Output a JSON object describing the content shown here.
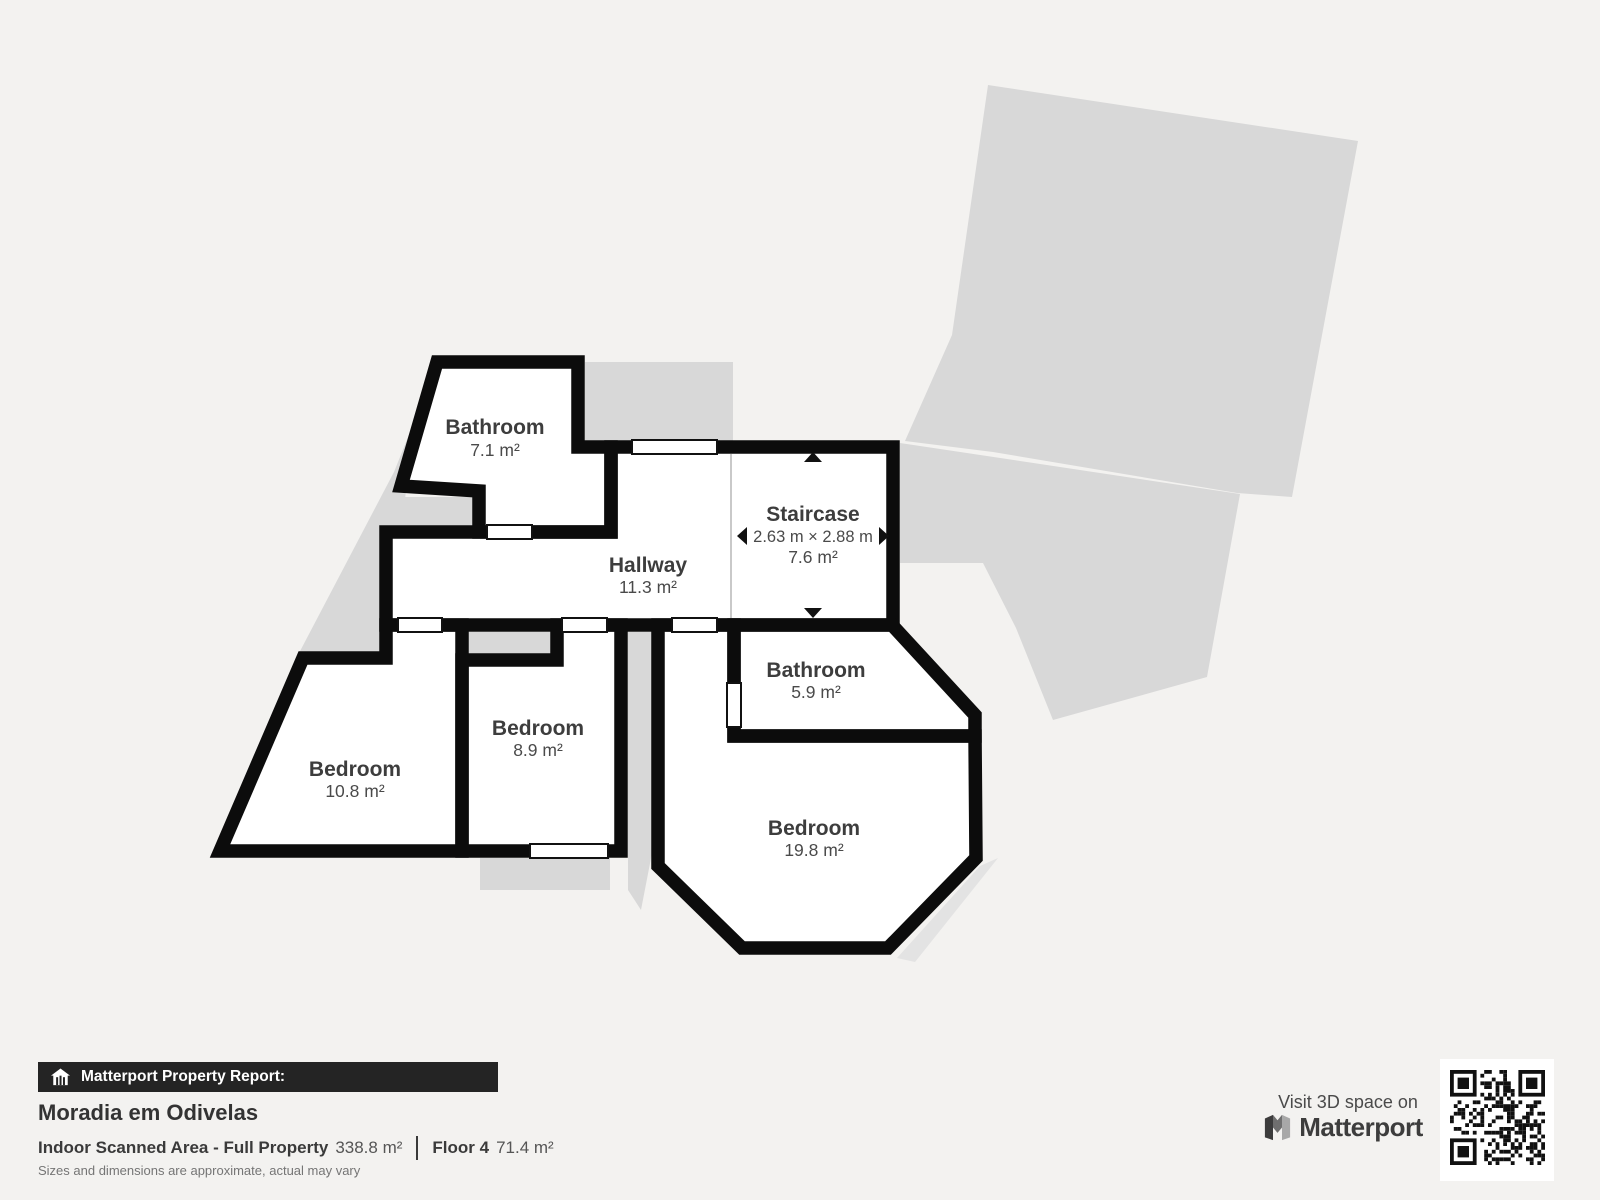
{
  "plan": {
    "rooms": [
      {
        "id": "bathroom-top",
        "name": "Bathroom",
        "area": "7.1 m²"
      },
      {
        "id": "hallway",
        "name": "Hallway",
        "area": "11.3 m²"
      },
      {
        "id": "staircase",
        "name": "Staircase",
        "dims": "2.63 m × 2.88 m",
        "area": "7.6 m²"
      },
      {
        "id": "bathroom-right",
        "name": "Bathroom",
        "area": "5.9 m²"
      },
      {
        "id": "bedroom-small",
        "name": "Bedroom",
        "area": "8.9 m²"
      },
      {
        "id": "bedroom-left",
        "name": "Bedroom",
        "area": "10.8 m²"
      },
      {
        "id": "bedroom-large",
        "name": "Bedroom",
        "area": "19.8 m²"
      }
    ]
  },
  "footer": {
    "report_label": "Matterport Property Report:",
    "property_name": "Moradia em Odivelas",
    "scanned_area_label": "Indoor Scanned Area - Full Property",
    "scanned_area_value": "338.8 m²",
    "floor_label": "Floor 4",
    "floor_value": "71.4 m²",
    "disclaimer": "Sizes and dimensions are approximate, actual may vary",
    "visit_label": "Visit 3D space on",
    "brand": "Matterport"
  },
  "icons": {
    "house": "house-icon",
    "matterport_logo": "matterport-logo-icon",
    "qr": "qr-code"
  },
  "colors": {
    "background": "#f3f2f0",
    "wall": "#0c0c0c",
    "underfloor_gray": "#d8d8d8",
    "room_fill": "#ffffff",
    "label_text": "#3d3d3d",
    "bar_background": "#242424"
  }
}
